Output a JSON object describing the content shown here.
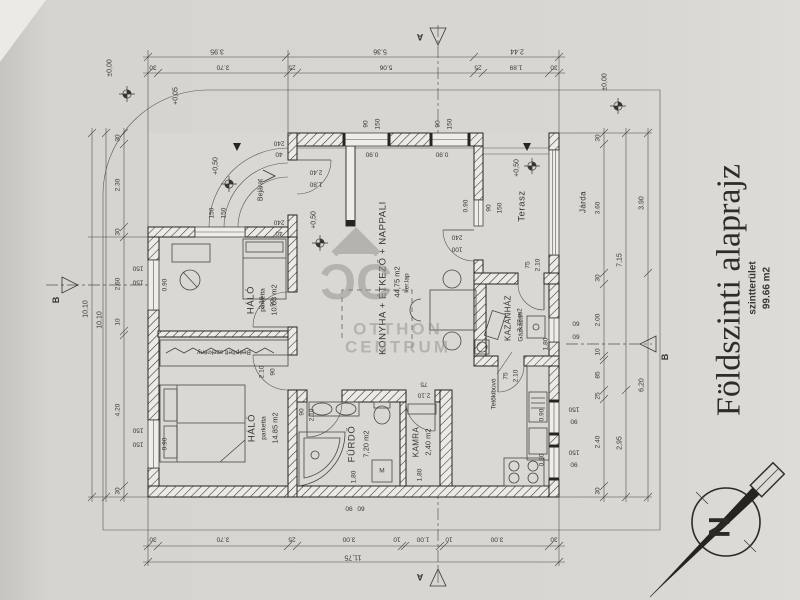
{
  "title": {
    "main": "Földszinti alaprajz",
    "sub": "szintterület",
    "area": "99.66 m2"
  },
  "rooms": {
    "living": {
      "name": "KONYHA + ÉTKEZŐ + NAPPALI",
      "area": "44,75 m2",
      "floor": "ker.lap"
    },
    "bedroom1": {
      "name": "HÁLÓ",
      "floor": "parketta",
      "area": "10.03 m2"
    },
    "bedroom2": {
      "name": "HÁLÓ",
      "floor": "parketta",
      "area": "14.85 m2"
    },
    "bathroom": {
      "name": "FÜRDŐ",
      "area": "7,20 m2"
    },
    "pantry": {
      "name": "KAMRA",
      "area": "2,40 m2"
    },
    "boiler": {
      "name": "KAZÁNHÁZ",
      "area": "3,78 m2"
    },
    "terrace": {
      "name": "Terasz"
    },
    "wardrobe": {
      "name": "Beépített  szekrény"
    },
    "entrance": {
      "name": "Bejárat"
    },
    "sidewalk": {
      "name": "Járda"
    }
  },
  "equipment": {
    "boiler_unit": "Gázkazán",
    "roof_hatch": "Tetőkibúvó",
    "washer": "M"
  },
  "levels": {
    "zero": "±0,00",
    "five": "+0,05",
    "fifty": "+0,50"
  },
  "sections": {
    "a": "A",
    "b": "B"
  },
  "compass": {
    "north": "N"
  },
  "watermark": {
    "logo": "ƆC",
    "line1": "OTTHON",
    "line2": "CENTRUM"
  },
  "dims": {
    "top_outer": [
      "3.95",
      "5.36",
      "2.44"
    ],
    "top_inner": [
      "30",
      "3.70",
      "25",
      "5.06",
      "25",
      "1.89",
      "30"
    ],
    "bottom": [
      "30",
      "3.70",
      "25",
      "3.00",
      "10",
      "1.00",
      "10",
      "3.00",
      "30"
    ],
    "bottom_total": "11,75",
    "left": [
      "30",
      "2.30",
      "30",
      "2.60",
      "10",
      "4.20",
      "30"
    ],
    "left_total_a": "10,10",
    "left_total_b": "10.10",
    "right_a": [
      "30",
      "3.60",
      "30",
      "2.00",
      "10",
      "85",
      "25",
      "2.40",
      "30"
    ],
    "right_b": [
      "7,15",
      "2,95"
    ],
    "right_c": [
      "3.90",
      "6,20"
    ]
  },
  "sizes": {
    "n90": "90",
    "n150": "150",
    "n100": "100",
    "n240": "240",
    "n40": "40",
    "n75": "75",
    "n60": "60",
    "n210": "2.10",
    "n180": "1,80",
    "n240h": "2,40",
    "sill": "0.90"
  }
}
